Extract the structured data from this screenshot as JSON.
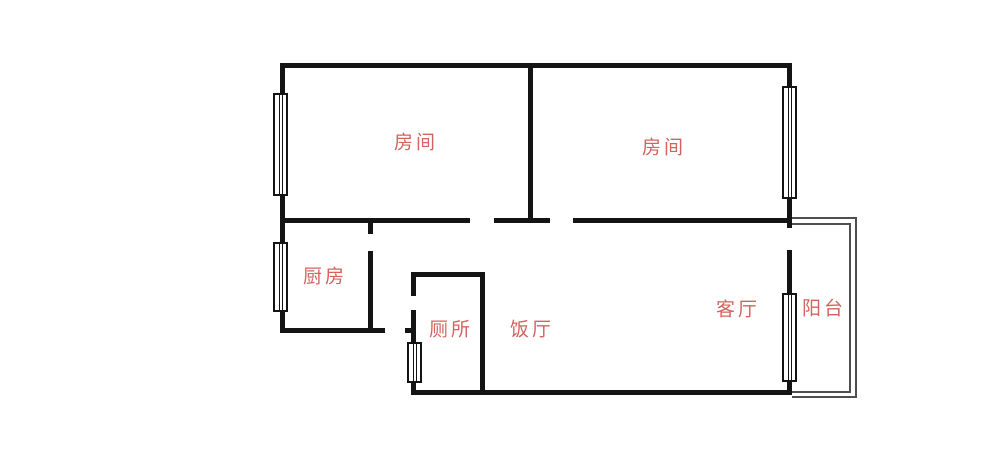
{
  "canvas": {
    "width": 1000,
    "height": 466,
    "background": "#ffffff"
  },
  "colors": {
    "wall": "#141414",
    "window_border": "#141414",
    "balcony_line": "#4f4f4f",
    "label_text": "#d4635f"
  },
  "floorplan": {
    "rooms": [
      {
        "id": "bedroom-1",
        "label": "房间",
        "cx": 416,
        "cy": 143
      },
      {
        "id": "bedroom-2",
        "label": "房间",
        "cx": 664,
        "cy": 148
      },
      {
        "id": "kitchen",
        "label": "厨房",
        "cx": 325,
        "cy": 277
      },
      {
        "id": "toilet",
        "label": "厕所",
        "cx": 451,
        "cy": 330
      },
      {
        "id": "dining",
        "label": "饭厅",
        "cx": 532,
        "cy": 330
      },
      {
        "id": "living",
        "label": "客厅",
        "cx": 738,
        "cy": 310
      },
      {
        "id": "balcony",
        "label": "阳台",
        "cx": 824,
        "cy": 309
      }
    ],
    "walls": [
      {
        "name": "top-wall",
        "x": 280,
        "y": 63,
        "w": 512,
        "h": 5
      },
      {
        "name": "left-wall",
        "x": 280,
        "y": 63,
        "w": 5,
        "h": 270
      },
      {
        "name": "right-wall-upper",
        "x": 787,
        "y": 63,
        "w": 5,
        "h": 165
      },
      {
        "name": "right-wall-mid",
        "x": 787,
        "y": 250,
        "w": 5,
        "h": 46
      },
      {
        "name": "right-wall-lower",
        "x": 787,
        "y": 380,
        "w": 5,
        "h": 15
      },
      {
        "name": "bedroom-divider-wall",
        "x": 528,
        "y": 63,
        "w": 5,
        "h": 160
      },
      {
        "name": "bedrooms-bottom-wall-a",
        "x": 280,
        "y": 218,
        "w": 190,
        "h": 5
      },
      {
        "name": "bedrooms-bottom-wall-b",
        "x": 494,
        "y": 218,
        "w": 56,
        "h": 5
      },
      {
        "name": "bedrooms-bottom-wall-c",
        "x": 573,
        "y": 218,
        "w": 219,
        "h": 5
      },
      {
        "name": "kitchen-right-wall-stub",
        "x": 368,
        "y": 223,
        "w": 5,
        "h": 11
      },
      {
        "name": "kitchen-right-wall",
        "x": 368,
        "y": 251,
        "w": 5,
        "h": 82
      },
      {
        "name": "kitchen-bottom-wall",
        "x": 280,
        "y": 328,
        "w": 105,
        "h": 5
      },
      {
        "name": "hall-wall-tick",
        "x": 405,
        "y": 328,
        "w": 11,
        "h": 5
      },
      {
        "name": "toilet-left-wall-stub",
        "x": 411,
        "y": 272,
        "w": 5,
        "h": 24
      },
      {
        "name": "toilet-left-wall-lower",
        "x": 411,
        "y": 310,
        "w": 5,
        "h": 82
      },
      {
        "name": "toilet-top-wall",
        "x": 411,
        "y": 272,
        "w": 74,
        "h": 5
      },
      {
        "name": "toilet-right-wall",
        "x": 480,
        "y": 272,
        "w": 5,
        "h": 123
      },
      {
        "name": "bottom-wall",
        "x": 411,
        "y": 390,
        "w": 381,
        "h": 5
      }
    ],
    "windows": [
      {
        "name": "bedroom-1-window",
        "x": 273,
        "y": 93,
        "w": 15,
        "h": 103
      },
      {
        "name": "kitchen-window",
        "x": 273,
        "y": 242,
        "w": 15,
        "h": 70
      },
      {
        "name": "bedroom-2-window",
        "x": 782,
        "y": 86,
        "w": 15,
        "h": 113
      },
      {
        "name": "living-window",
        "x": 782,
        "y": 293,
        "w": 15,
        "h": 89
      },
      {
        "name": "toilet-window",
        "x": 407,
        "y": 342,
        "w": 15,
        "h": 41
      }
    ],
    "balcony_outline": {
      "outer": {
        "x": 792,
        "y": 217,
        "w": 65,
        "h": 181
      },
      "inner": {
        "x": 792,
        "y": 223,
        "w": 59,
        "h": 170
      }
    }
  }
}
